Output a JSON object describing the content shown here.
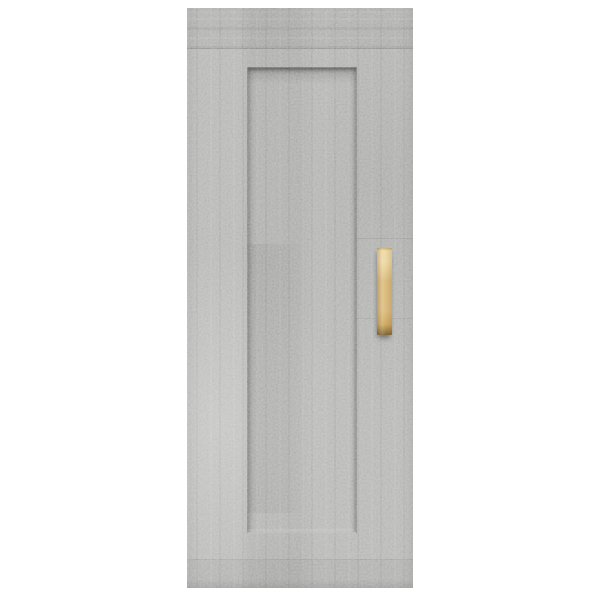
{
  "page": {
    "background_color": "#ffffff"
  },
  "product_photo": {
    "subject": "Wall cabinet door in concrete grey with recessed centre panel and vertical natural-wood bar handle on white background",
    "parts": {
      "cabinet_door": "concrete-grey speckled board with recessed rectangular centre panel",
      "handle": "light natural wood vertical bar handle on right stile"
    }
  },
  "colors": {
    "background": "#ffffff",
    "cabinet_base": "#b5b5b3",
    "cabinet_light": "#c8c8c6",
    "cabinet_dark": "#9b9b99",
    "recess_shadow": "#5f5f5d",
    "edge_highlight": "#d8d8d6",
    "handle_wood": "#dcbd80",
    "handle_wood_light": "#eed9a6",
    "handle_wood_dark": "#9a7d46"
  }
}
